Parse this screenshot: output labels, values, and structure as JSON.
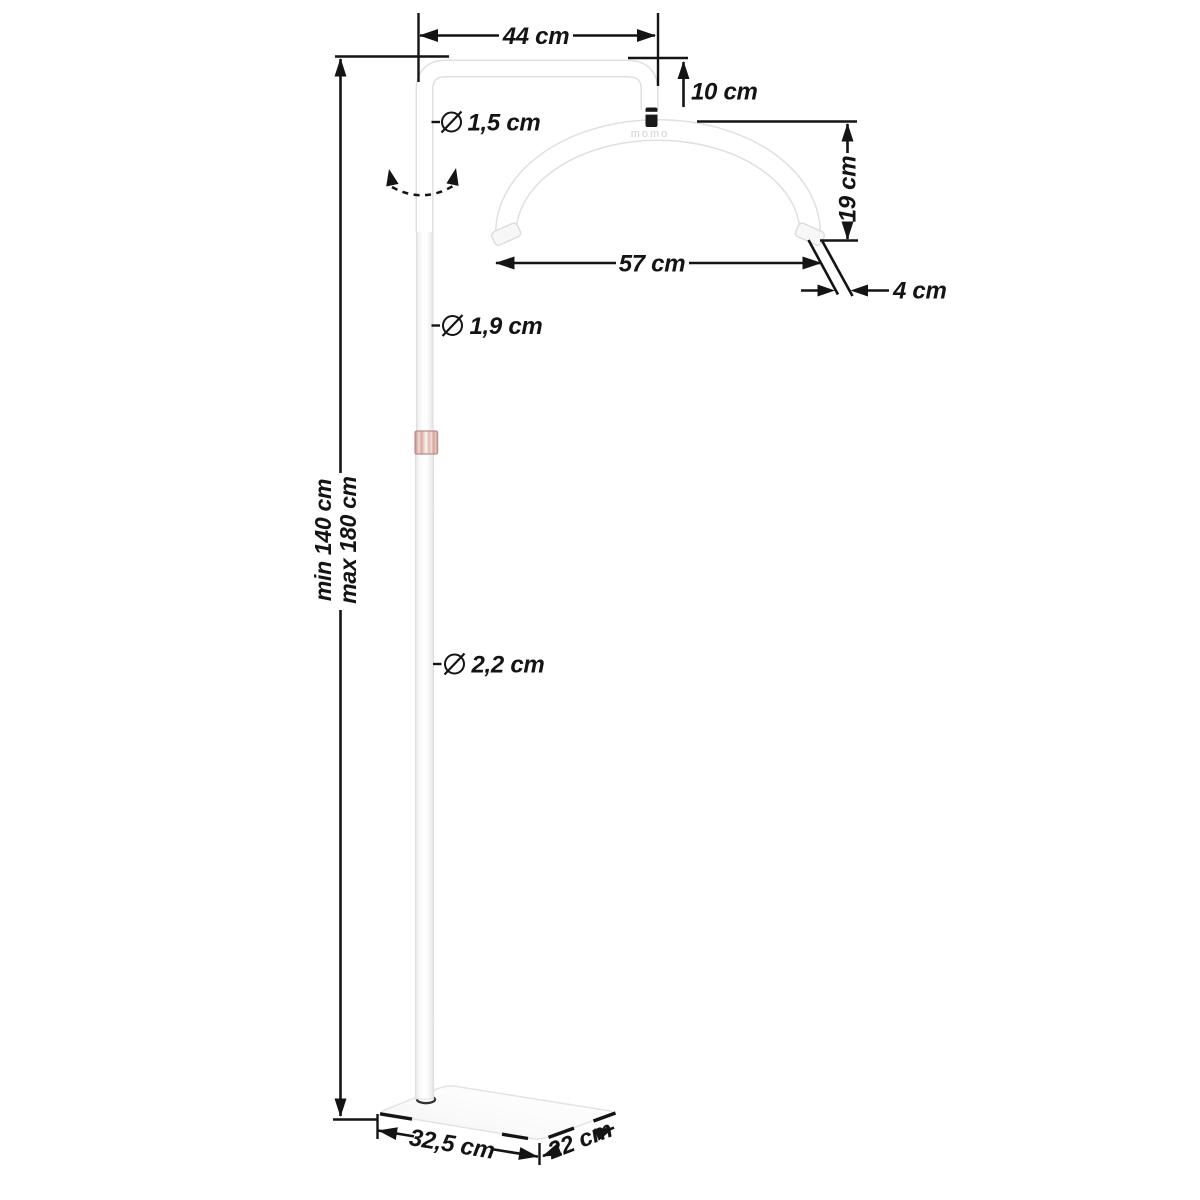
{
  "illustration": {
    "brand_logo": "momo"
  },
  "dims": {
    "arm_width": "44 cm",
    "head_drop": "10 cm",
    "arc_height": "19 cm",
    "arc_width": "57 cm",
    "tube_thickness": "4 cm",
    "pole_top_diameter": "1,5 cm",
    "pole_mid_diameter": "1,9 cm",
    "pole_bottom_diameter": "2,2 cm",
    "height_min": "min 140 cm",
    "height_max": "max 180 cm",
    "base_width": "32,5 cm",
    "base_depth": "22 cm"
  },
  "icons": {
    "diameter": "∅",
    "rotation": "curved-double-arrow"
  },
  "colors": {
    "dimension_line": "#141414",
    "lamp_outline": "#e0e0e0",
    "collar_rose_gold": "#d8a49d",
    "logo_gray": "#d2d2d2",
    "background": "#ffffff"
  }
}
